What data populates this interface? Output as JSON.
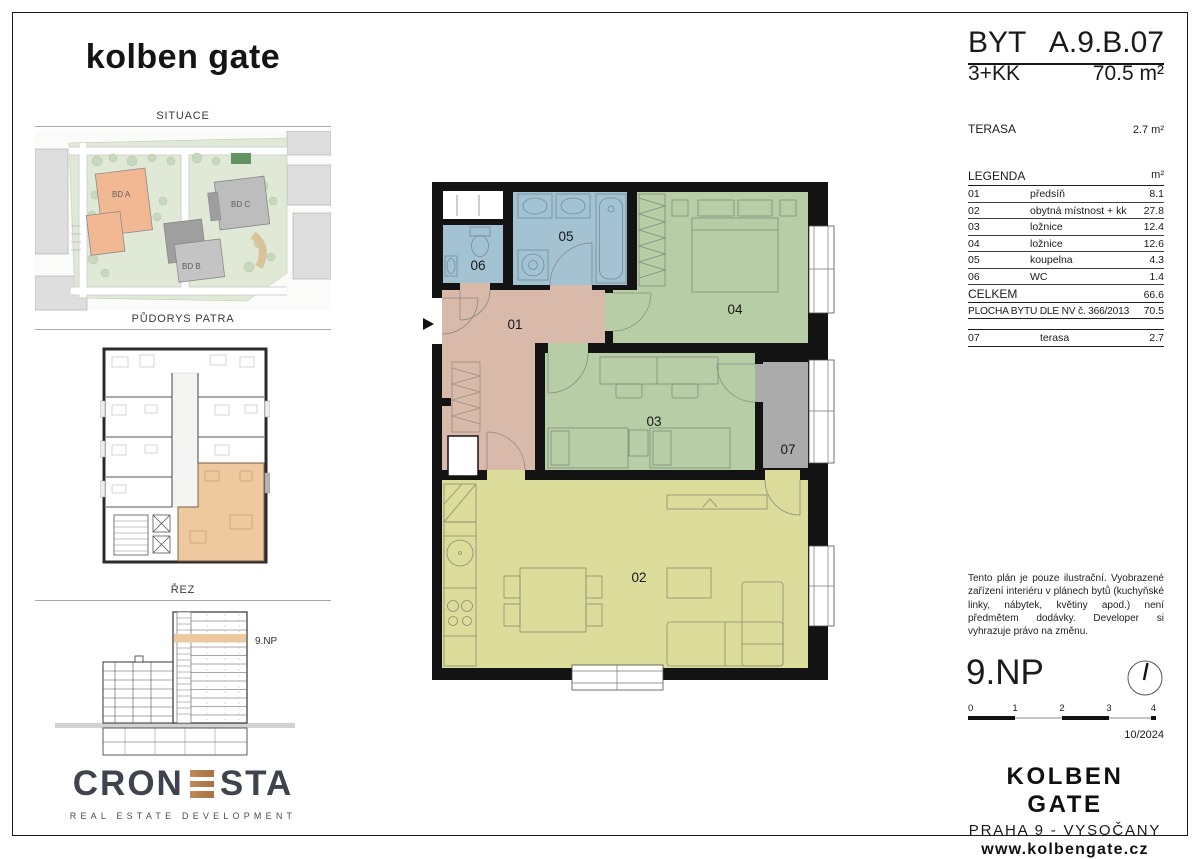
{
  "sidebar": {
    "brand": "kolben gate",
    "situace_title": "SITUACE",
    "pudorys_title": "PŮDORYS PATRA",
    "rez_title": "ŘEZ",
    "building_a": "BD A",
    "building_b": "BD B",
    "building_c": "BD C",
    "section_floor_label": "9.NP",
    "cronesta_left": "CRON",
    "cronesta_right": "STA",
    "cronesta_subtitle": "REAL ESTATE DEVELOPMENT"
  },
  "title_block": {
    "unit_label": "BYT",
    "unit_code": "A.9.B.07",
    "disposition": "3+KK",
    "area": "70.5 m²",
    "terasa_label": "TERASA",
    "terasa_area": "2.7 m²"
  },
  "legend": {
    "title": "LEGENDA",
    "unit_header": "m²",
    "rows": [
      {
        "num": "01",
        "name": "předsíň",
        "area": "8.1"
      },
      {
        "num": "02",
        "name": "obytná místnost + kk",
        "area": "27.8"
      },
      {
        "num": "03",
        "name": "ložnice",
        "area": "12.4"
      },
      {
        "num": "04",
        "name": "ložnice",
        "area": "12.6"
      },
      {
        "num": "05",
        "name": "koupelna",
        "area": "4.3"
      },
      {
        "num": "06",
        "name": "WC",
        "area": "1.4"
      }
    ],
    "total_label": "CELKEM",
    "total_area": "66.6",
    "statutory_label": "PLOCHA BYTU DLE NV č. 366/2013",
    "statutory_area": "70.5",
    "terrace_num": "07",
    "terrace_name": "terasa",
    "terrace_area": "2.7"
  },
  "plan": {
    "rooms": {
      "r01": "01",
      "r02": "02",
      "r03": "03",
      "r04": "04",
      "r05": "05",
      "r06": "06",
      "r07": "07"
    }
  },
  "disclaimer": "Tento plán je pouze ilustrační. Vyobrazené zařízení interiéru v plánech bytů (kuchyňské linky, nábytek, květiny apod.) není předmětem dodávky. Developer si vyhrazuje právo na změnu.",
  "footer": {
    "floor_label": "9.NP",
    "scale_ticks": [
      "0",
      "1",
      "2",
      "3",
      "4"
    ],
    "date": "10/2024",
    "project": "KOLBEN GATE",
    "location": "PRAHA 9 - VYSOČANY",
    "website": "www.kolbengate.cz"
  },
  "colors": {
    "wall": "#131313",
    "bath": "#a3c3d3",
    "bedroom": "#b7cda6",
    "hall": "#d9b9a9",
    "living": "#dcdc9b",
    "terrace": "#ababab",
    "highlight": "#eec9a0",
    "building_a_fill": "#f2b894",
    "cronesta_copper": "#b97c4d"
  }
}
